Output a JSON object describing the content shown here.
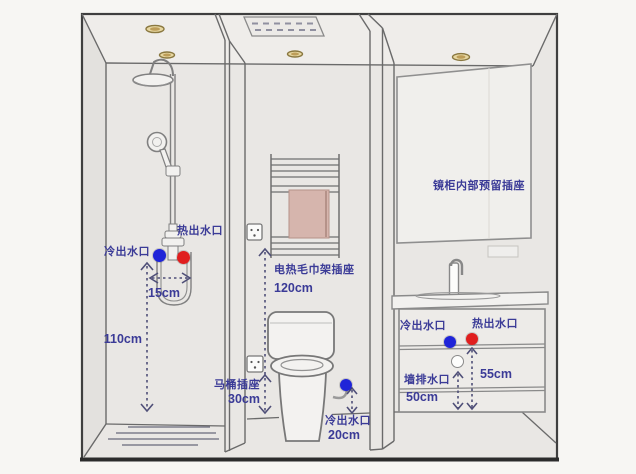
{
  "diagram_type": "bathroom-rough-in-layout",
  "colors": {
    "cold": "#1f24d8",
    "hot": "#e01e1e",
    "label": "#3b3b97",
    "measure_line": "#4f4f78"
  },
  "icons": {
    "power_socket": "socket-square",
    "cold_outlet": "blue-dot",
    "hot_outlet": "red-dot",
    "wall_drain": "white-circle",
    "downlight": "ceiling-oval",
    "exhaust_fan": "vent-panel-dashed"
  },
  "shower": {
    "cold_outlet_label": "冷出水口",
    "hot_outlet_label": "热出水口",
    "spacing_value": "15cm",
    "height_value": "110cm"
  },
  "toilet_area": {
    "towel_rack_socket_label": "电热毛巾架插座",
    "towel_rack_socket_height": "120cm",
    "toilet_socket_label": "马桶插座",
    "toilet_socket_height": "30cm",
    "cold_outlet_label": "冷出水口",
    "cold_outlet_height": "20cm"
  },
  "vanity": {
    "mirror_cabinet_label": "镜柜内部预留插座",
    "cold_outlet_label": "冷出水口",
    "hot_outlet_label": "热出水口",
    "wall_drain_label": "墙排水口",
    "wall_drain_height": "50cm",
    "hot_outlet_height": "55cm"
  }
}
